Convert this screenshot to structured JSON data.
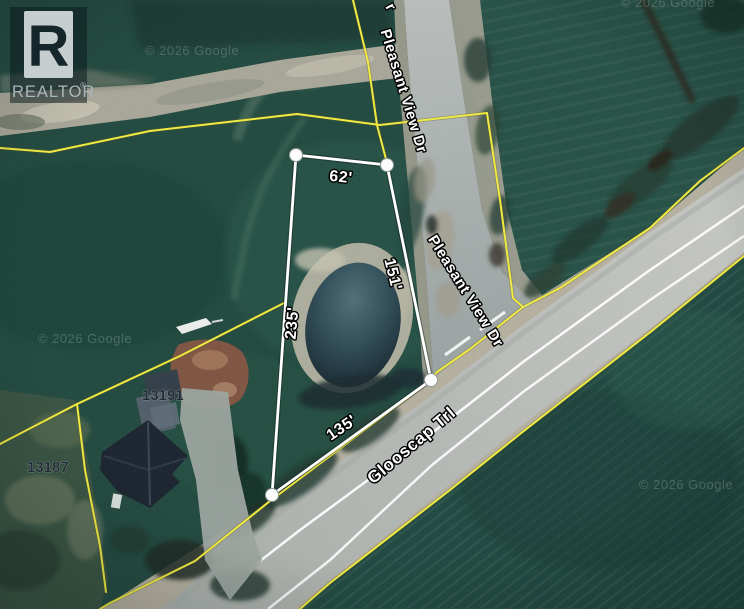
{
  "logo": {
    "letter": "R",
    "brand": "REALTOR",
    "registered": "®"
  },
  "roads": {
    "pleasant_view_dr": "Pleasant View Dr",
    "pleasant_view_dr_2": "Pleasant View Dr",
    "pleasant_view_partial": "r",
    "glooscap_trl": "Glooscap Trl"
  },
  "measurements": {
    "front": "62'",
    "side_right": "151'",
    "side_left": "235'",
    "rear": "135'"
  },
  "house_numbers": {
    "house_1": "13191",
    "house_2": "13187"
  },
  "watermark": {
    "text": "© 2026 Google"
  },
  "colors": {
    "parcel_line": "#efe93d",
    "survey_line": "#ffffff",
    "field_green": "#1e463c",
    "road_gray": "#b9bcb8",
    "pond_water": "#1c3340"
  }
}
